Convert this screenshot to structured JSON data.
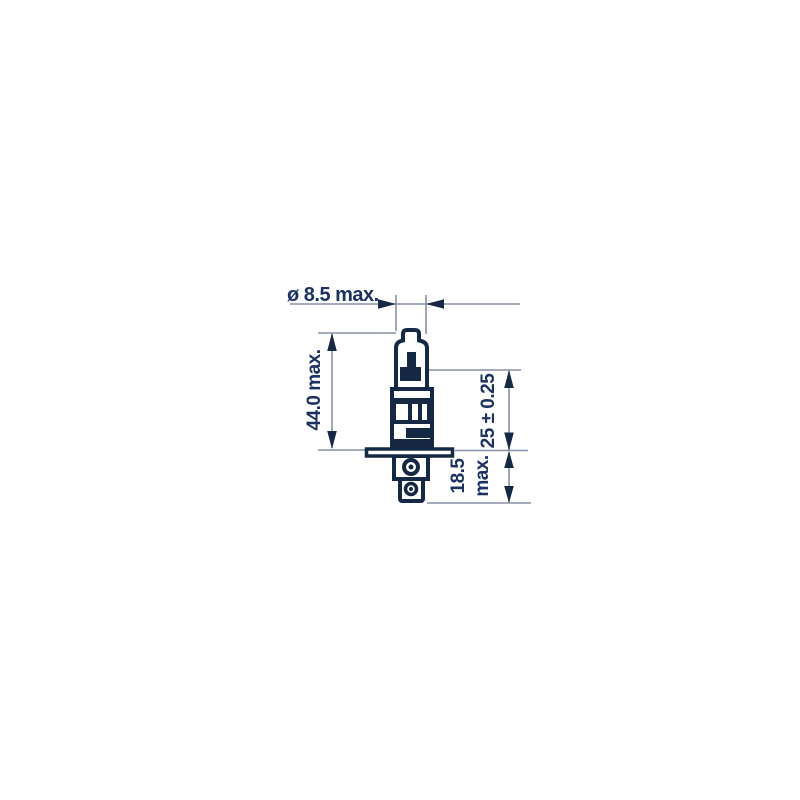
{
  "diagram": {
    "title": "H1 halogen bulb technical dimension drawing",
    "dimensions": {
      "diameter_label": "ø 8.5 max.",
      "overall_length_label": "44.0 max.",
      "light_center_length_label": "25 ± 0.25",
      "base_length_label_line1": "18.5",
      "base_length_label_line2": "max."
    },
    "colors": {
      "background": "#ffffff",
      "drawing_outline": "#152844",
      "label_text": "#1c3160",
      "thin_dimension_line": "#8591a6"
    }
  }
}
